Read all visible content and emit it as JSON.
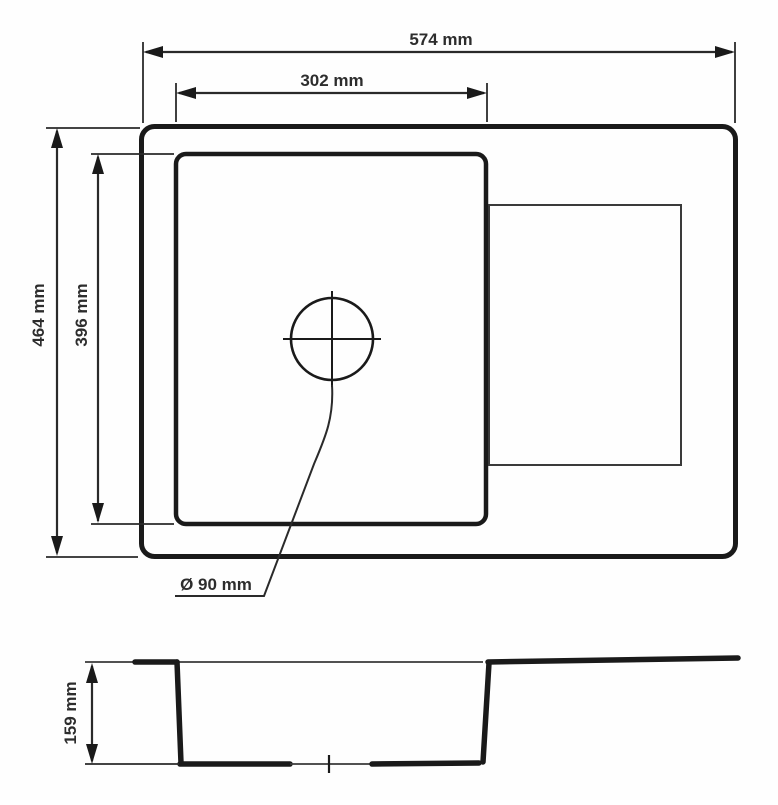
{
  "drawing": {
    "subject": "sink-dimension-drawing",
    "colors": {
      "line": "#1a1a1a",
      "thin_line": "#3a3a3a",
      "background": "#fefefe",
      "text": "#2d2d2d"
    },
    "labels": {
      "overall_width": "574 mm",
      "bowl_width": "302 mm",
      "overall_depth": "464 mm",
      "bowl_depth": "396 mm",
      "drain_diameter": "Ø 90 mm",
      "bowl_height": "159 mm"
    },
    "views": {
      "top_view": "plan view of sink with bowl, drainer and drain hole",
      "side_view": "cross-section profile of sink bowl"
    }
  }
}
